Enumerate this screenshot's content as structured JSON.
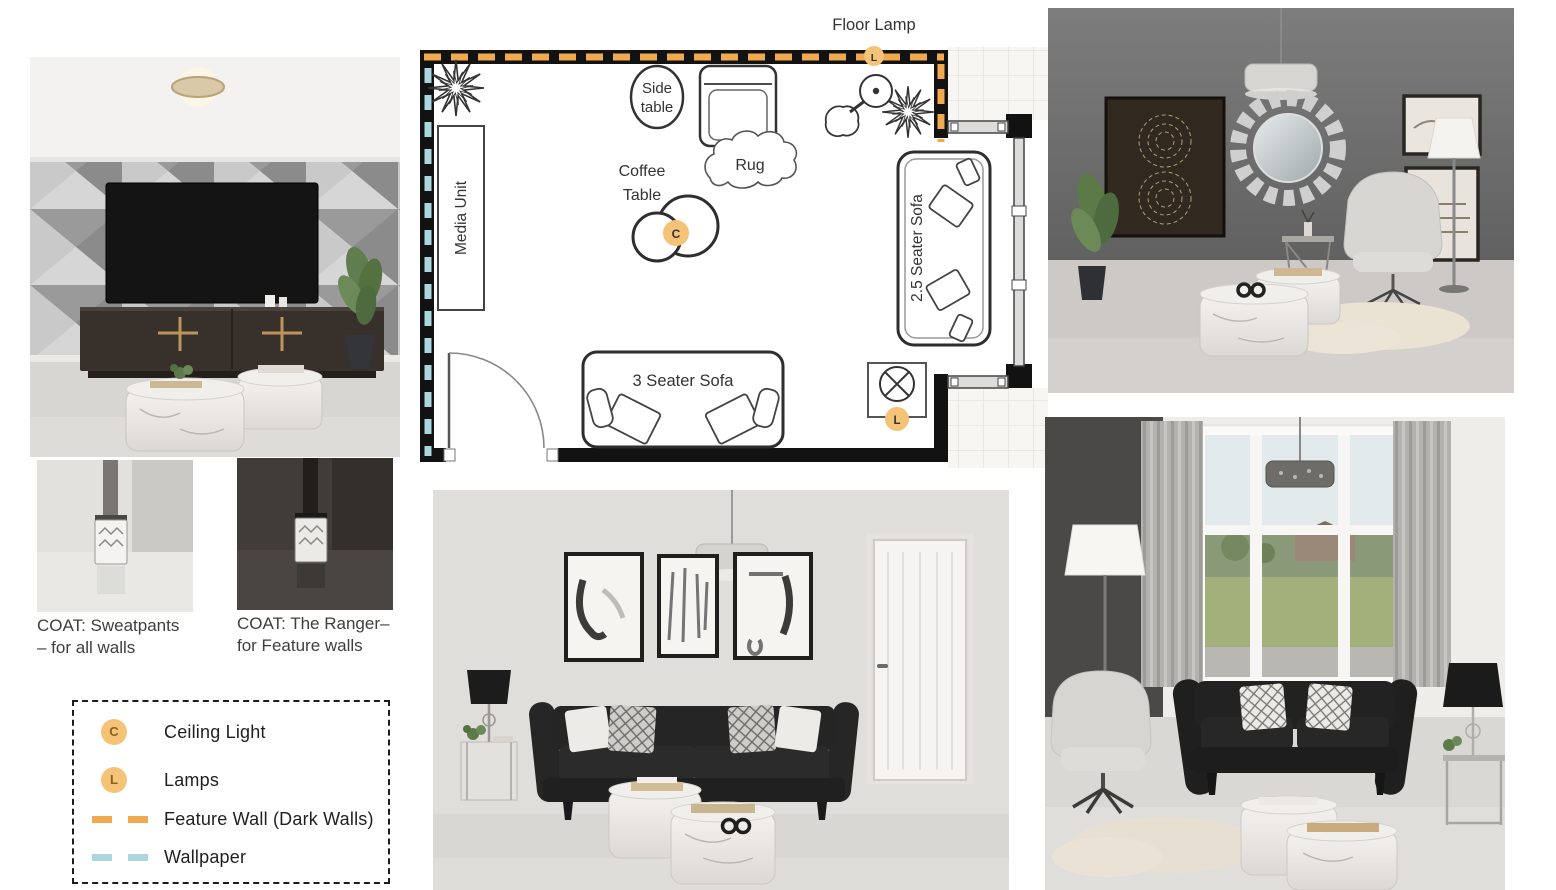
{
  "floor_plan": {
    "labels": {
      "floor_lamp": "Floor Lamp",
      "side_table_1": "Side",
      "side_table_2": "table",
      "rug": "Rug",
      "coffee_1": "Coffee",
      "coffee_2": "Table",
      "media_unit": "Media Unit",
      "sofa_25": "2.5 Seater Sofa",
      "sofa_3": "3 Seater Sofa"
    },
    "badges": {
      "ceiling_light": "C",
      "lamp_top": "L",
      "lamp_bottom": "L"
    },
    "colors": {
      "wall": "#121212",
      "feature_wall_dash": "#F0A94F",
      "wallpaper_dash": "#ABD7DF",
      "badge_fill": "#F4C377",
      "badge_letter": "#8B5E1A"
    }
  },
  "legend": {
    "items": [
      {
        "symbol": "badge",
        "letter": "C",
        "label": "Ceiling Light"
      },
      {
        "symbol": "badge",
        "letter": "L",
        "label": "Lamps"
      },
      {
        "symbol": "dash",
        "color": "#F0A94F",
        "label": "Feature Wall (Dark Walls)"
      },
      {
        "symbol": "dash",
        "color": "#ABD7DF",
        "label": "Wallpaper"
      }
    ]
  },
  "swatches": [
    {
      "caption_line1": "COAT: Sweatpants",
      "caption_line2": "– for all walls"
    },
    {
      "caption_line1": "COAT: The Ranger–",
      "caption_line2": "for Feature walls"
    }
  ]
}
